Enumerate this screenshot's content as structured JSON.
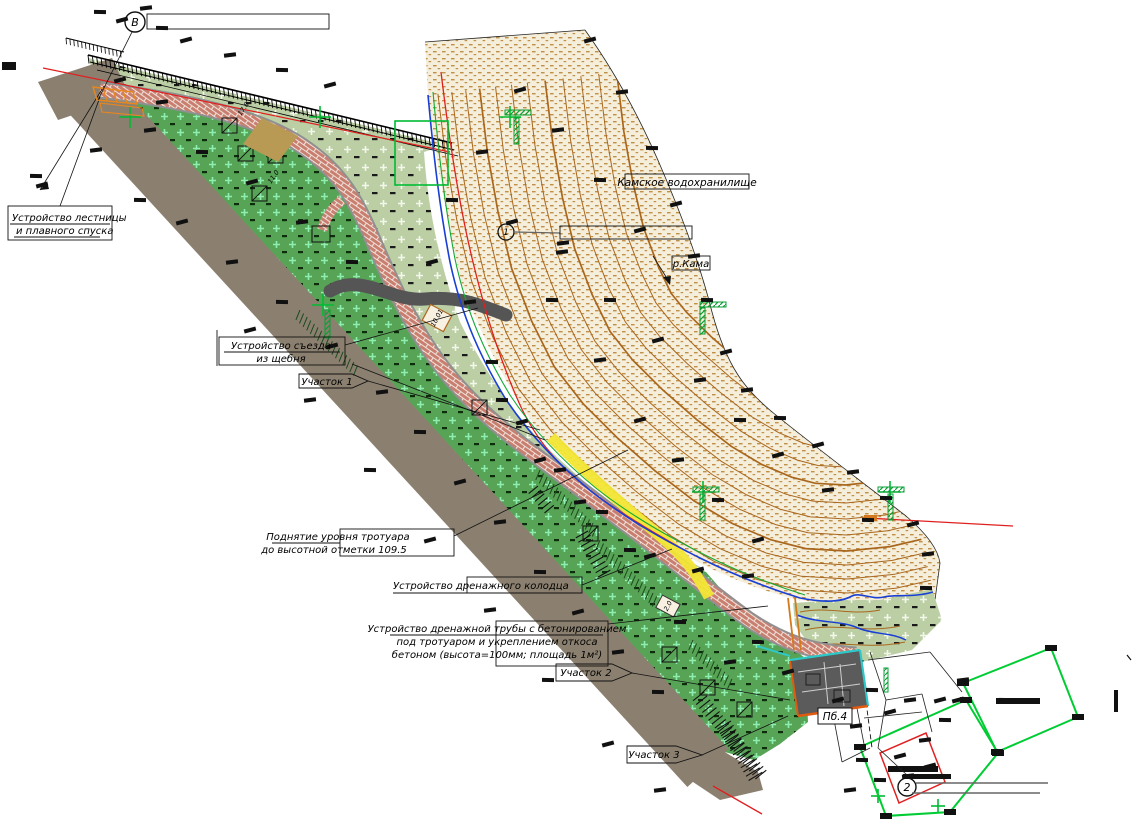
{
  "drawing": {
    "annotations": {
      "stairs": {
        "lines": [
          "Устройство лестницы",
          "и плавного спуска"
        ]
      },
      "gravel_ramp": {
        "lines": [
          "Устройство съезда",
          "из щебня"
        ]
      },
      "plot1": "Участок 1",
      "plot2": "Участок 2",
      "plot3": "Участок 3",
      "sidewalk_raise": {
        "lines": [
          "Поднятие уровня тротуара",
          "до высотной отметки 109.5"
        ]
      },
      "drain_well": "Устройство дренажного колодца",
      "drain_pipe": {
        "lines": [
          "Устройство дренажной трубы с бетонированием",
          "под тротуаром и укреплением откоса",
          "бетоном (высота=100мм; площадь 1м²)"
        ]
      },
      "reservoir": "Камское водохранилище",
      "river": "р.Кама",
      "building": "Пб.4",
      "section_marker_top": "В",
      "detail_marker": "1",
      "section_marker_bottom": "2",
      "tree_tags": [
        "7.5",
        "9.2",
        "11.0",
        "17.8"
      ],
      "elevation_tags": [
        "10.01",
        "2.0"
      ]
    },
    "colors": {
      "lawn_dark": "#57a457",
      "lawn_light": "#bccfa4",
      "beach_sand": "#f5eedb",
      "sand_dash": "#c09048",
      "road": "#8b8070",
      "brick": "#c97f70",
      "contour": "#a9671e",
      "water_edge": "#1a3fd4",
      "shore_green": "#11aa33",
      "survey_green": "#00bb33",
      "highlight": "#f2e635",
      "alert_red": "#e02020",
      "driveway": "#555555",
      "building": "#5b5b5b",
      "building_edge_cyan": "#2ec8c8",
      "building_edge_orange": "#e05a10",
      "stairs_orange": "#e8871e"
    }
  }
}
